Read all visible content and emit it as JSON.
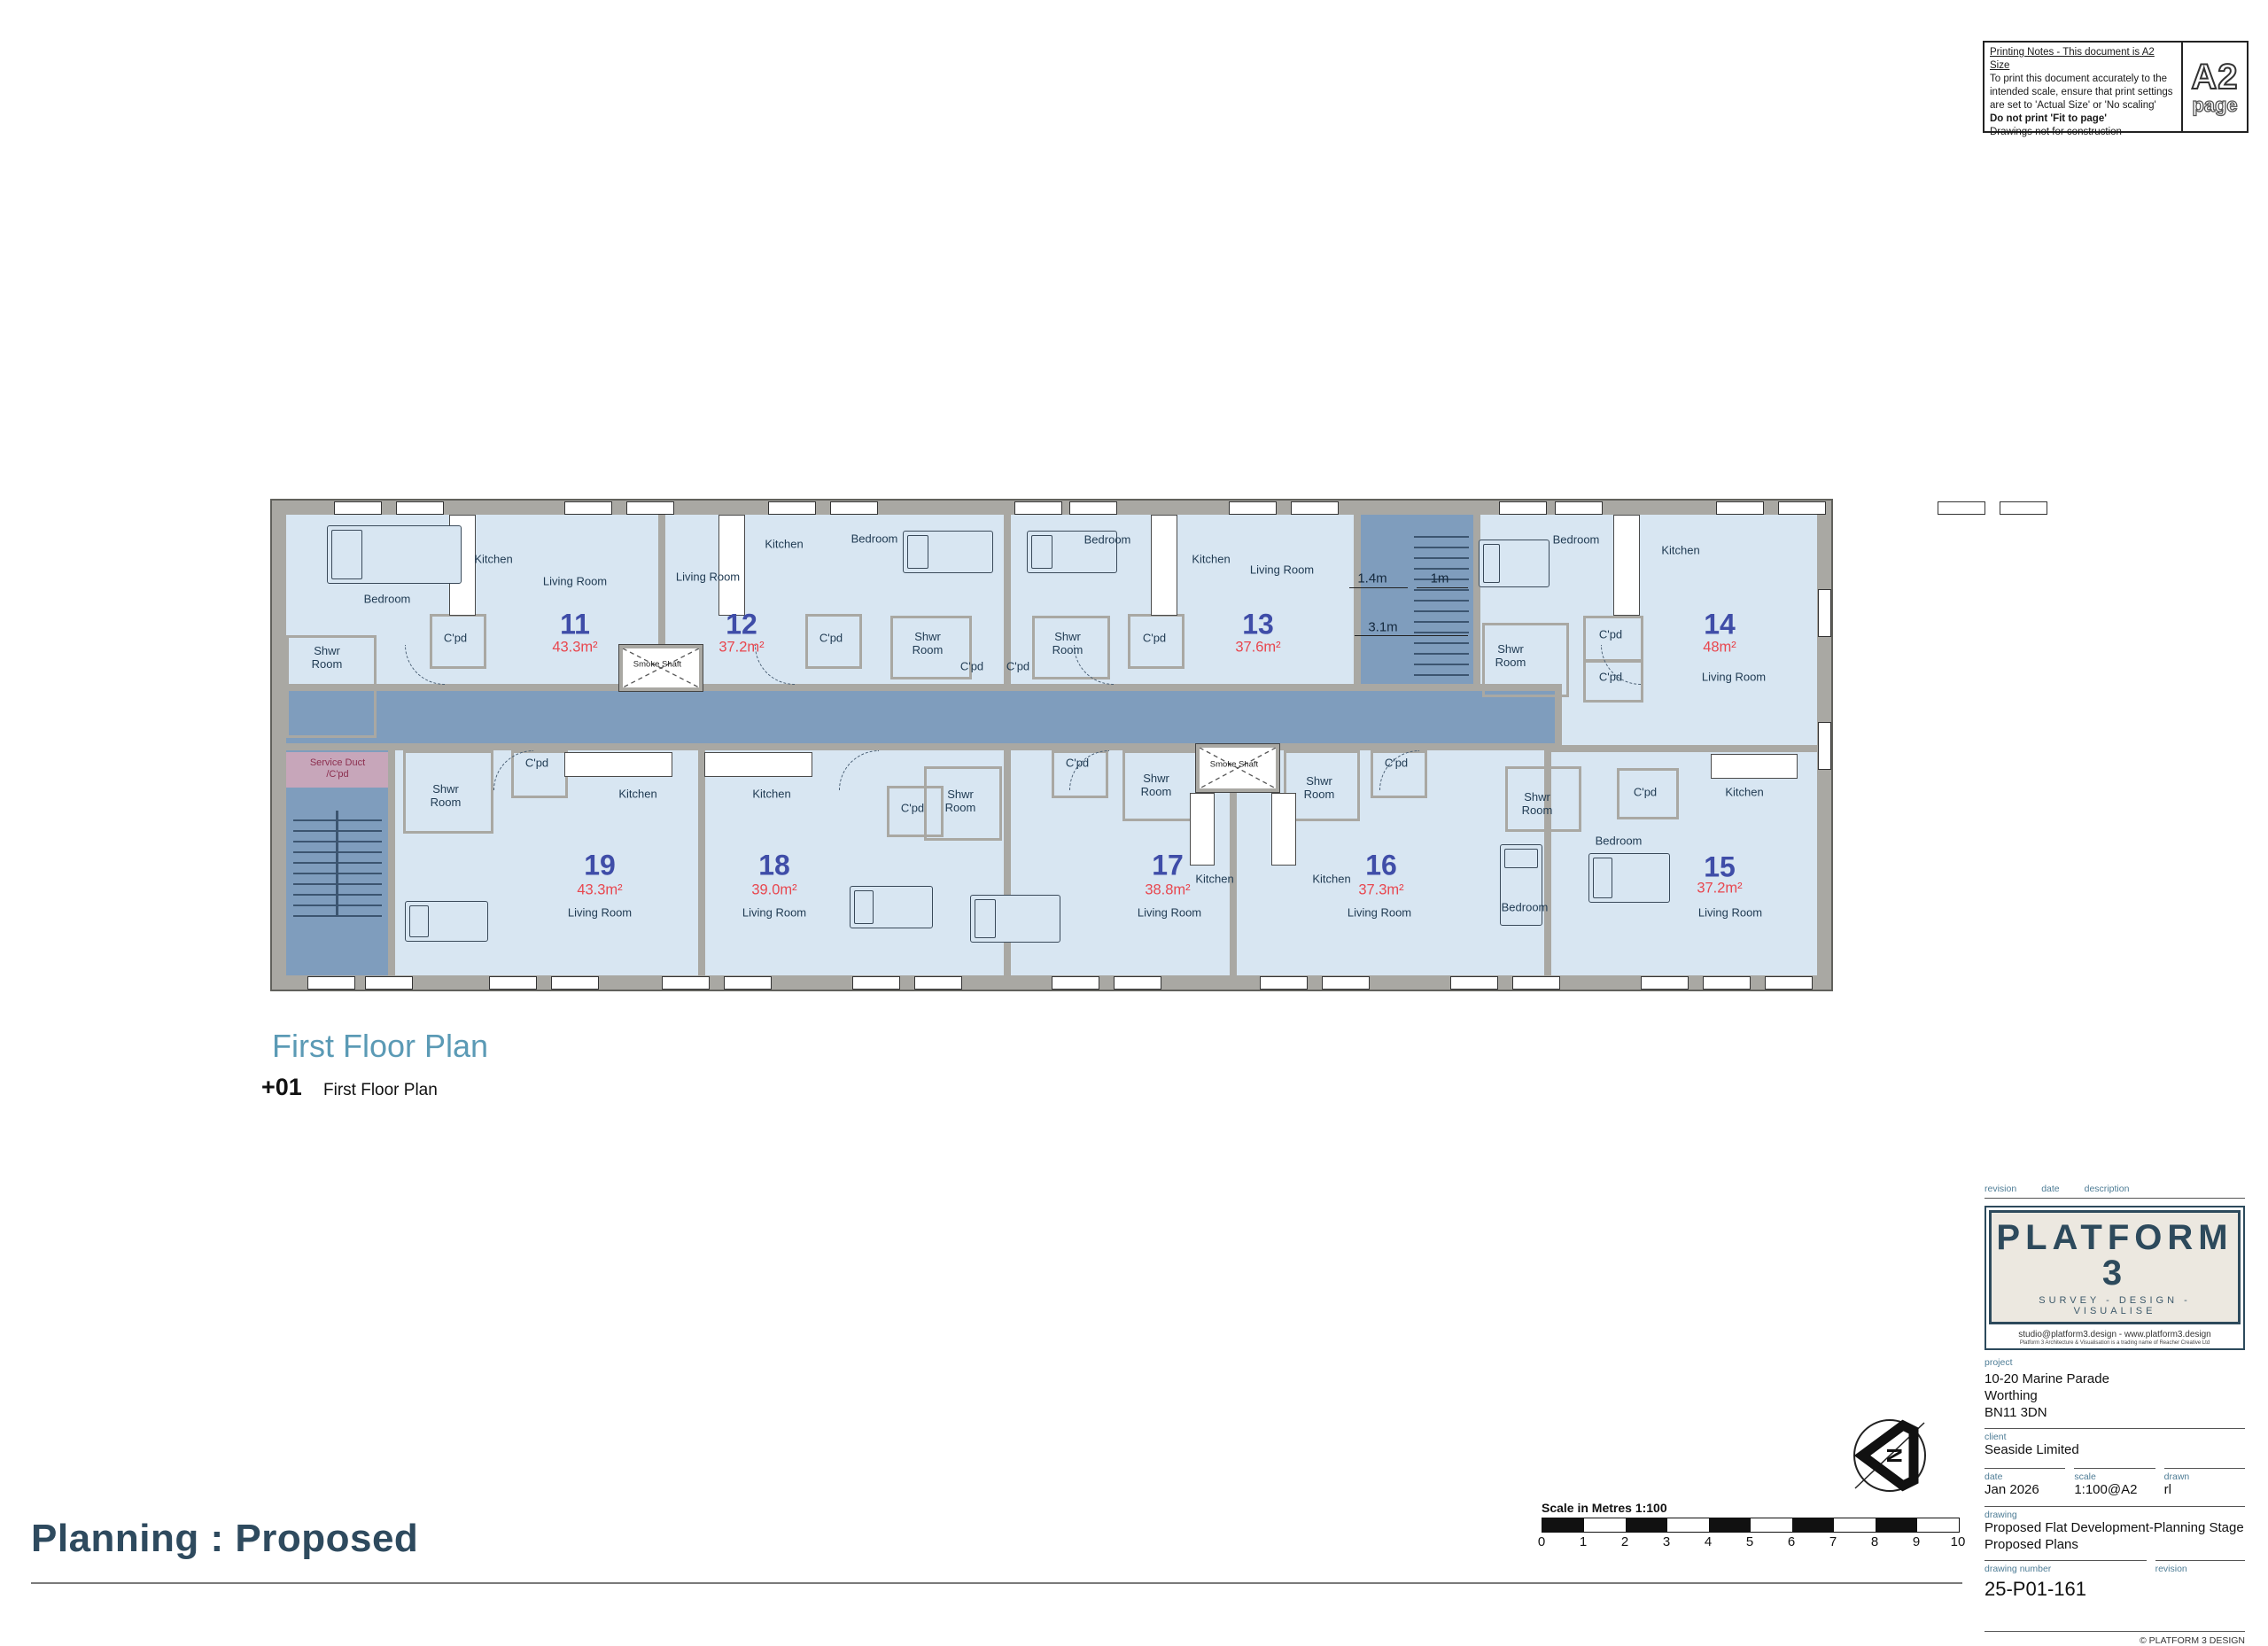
{
  "printing_notes": {
    "title": "Printing Notes - This document is A2 Size",
    "lines": [
      "To print this document accurately to the",
      "intended scale, ensure that print settings",
      "are set to 'Actual Size' or 'No scaling'"
    ],
    "bold_line": "Do not print 'Fit to page'",
    "last_line": "Drawings not for construction",
    "badge_top": "A2",
    "badge_bottom": "page"
  },
  "plan": {
    "room_names": {
      "kitchen": "Kitchen",
      "living": "Living Room",
      "bedroom": "Bedroom",
      "cpd": "C'pd",
      "shwr": "Shwr Room",
      "smoke": "Smoke Shaft",
      "service": "Service Duct /C'pd"
    },
    "flats": [
      {
        "number": "11",
        "area": "43.3m²"
      },
      {
        "number": "12",
        "area": "37.2m²"
      },
      {
        "number": "13",
        "area": "37.6m²"
      },
      {
        "number": "14",
        "area": "48m²"
      },
      {
        "number": "15",
        "area": "37.2m²"
      },
      {
        "number": "16",
        "area": "37.3m²"
      },
      {
        "number": "17",
        "area": "38.8m²"
      },
      {
        "number": "18",
        "area": "39.0m²"
      },
      {
        "number": "19",
        "area": "43.3m²"
      }
    ],
    "dimensions": {
      "stair_width": "1.4m",
      "flight_width": "1m",
      "stair_length": "3.1m"
    }
  },
  "caption": {
    "title": "First Floor Plan",
    "level_code": "+01",
    "level_label": "First Floor Plan"
  },
  "footer": {
    "stage_title": "Planning : Proposed",
    "copyright": "© PLATFORM 3 DESIGN"
  },
  "scale_bar": {
    "label": "Scale in Metres 1:100",
    "ticks": [
      "0",
      "1",
      "2",
      "3",
      "4",
      "5",
      "6",
      "7",
      "8",
      "9",
      "10"
    ]
  },
  "title_block": {
    "rev_hdr": {
      "revision": "revision",
      "date": "date",
      "description": "description"
    },
    "logo": {
      "name": "PLATFORM 3",
      "tagline": "SURVEY - DESIGN - VISUALISE",
      "contact": "studio@platform3.design - www.platform3.design",
      "legal": "Platform 3 Architecture & Visualisation is a trading name of Reacher Creative Ltd"
    },
    "project_label": "project",
    "project_line1": "10-20 Marine Parade",
    "project_line2": "Worthing",
    "project_line3": "BN11 3DN",
    "client_label": "client",
    "client": "Seaside Limited",
    "date_label": "date",
    "date": "Jan 2026",
    "scale_label": "scale",
    "scale": "1:100@A2",
    "drawn_label": "drawn",
    "drawn": "rl",
    "drawing_label": "drawing",
    "drawing_line1": "Proposed Flat Development-Planning Stage",
    "drawing_line2": "Proposed Plans",
    "drawing_number_label": "drawing number",
    "drawing_number": "25-P01-161",
    "revision_label": "revision"
  }
}
